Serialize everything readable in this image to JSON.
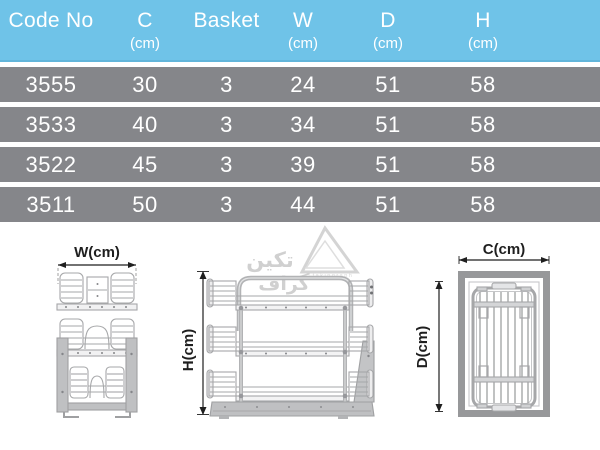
{
  "table": {
    "header": [
      {
        "label": "Code No",
        "unit": ""
      },
      {
        "label": "C",
        "unit": "(cm)"
      },
      {
        "label": "Basket",
        "unit": ""
      },
      {
        "label": "W",
        "unit": "(cm)"
      },
      {
        "label": "D",
        "unit": "(cm)"
      },
      {
        "label": "H",
        "unit": "(cm)"
      }
    ],
    "rows": [
      {
        "cells": [
          "3555",
          "30",
          "3",
          "24",
          "51",
          "58"
        ]
      },
      {
        "cells": [
          "3533",
          "40",
          "3",
          "34",
          "51",
          "58"
        ]
      },
      {
        "cells": [
          "3522",
          "45",
          "3",
          "39",
          "51",
          "58"
        ]
      },
      {
        "cells": [
          "3511",
          "50",
          "3",
          "44",
          "51",
          "58"
        ]
      }
    ]
  },
  "diagrams": {
    "front_view": {
      "dimension_label": "W(cm)"
    },
    "side_view": {
      "dimension_label": "H(cm)"
    },
    "top_view": {
      "width_label": "C(cm)",
      "depth_label": "D(cm)"
    }
  },
  "watermark": {
    "line1": "تکین",
    "line2": "گراف",
    "latin": "takingraph"
  },
  "colors": {
    "header_bg": "#6fc3e8",
    "row_bg": "#85868a",
    "table_text": "#ffffff",
    "dimension_ink": "#1f1f1f",
    "drawing_line": "#a6a7a9",
    "drawing_fill": "#bfc0c2",
    "frame_gray": "#97989a",
    "watermark_gray": "#d2d2d2"
  }
}
